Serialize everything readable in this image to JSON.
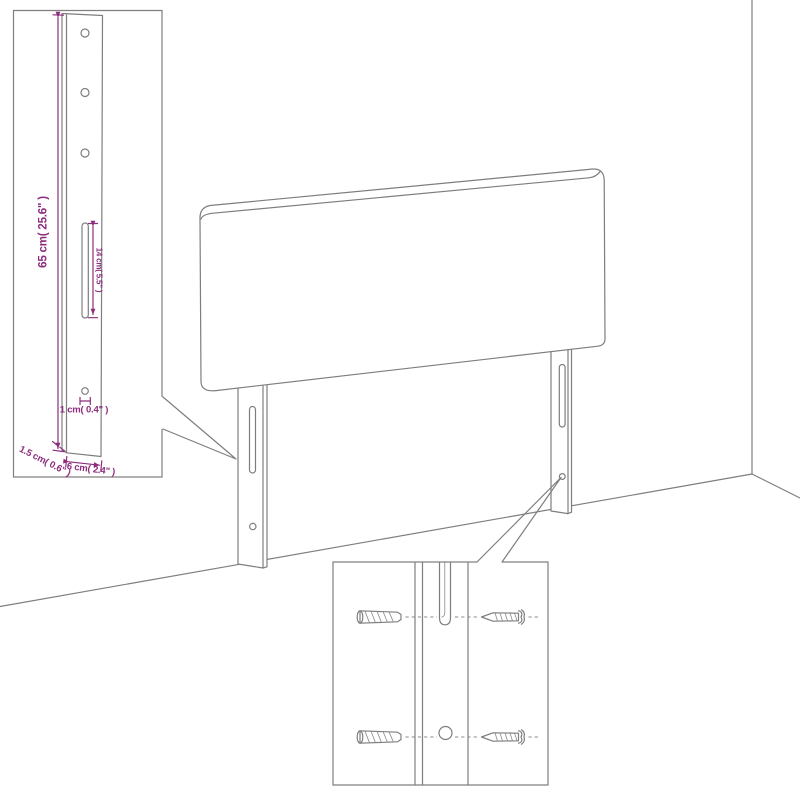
{
  "figure": {
    "description": "headboard with legs standing against wall corner, with enlarged leg-dimension inset and wall-mounting hardware inset",
    "colors": {
      "line_gray": "#7e7e7e",
      "dimension_magenta": "#8c2d7d",
      "background": "#ffffff"
    },
    "leg_detail_inset": {
      "height_label": "65 cm( 25.6\" )",
      "slot_label": "14 cm( 5.5\" )",
      "hole_label": "1 cm( 0.4\" )",
      "thickness_label": "1.5 cm( 0.6\" )",
      "width_label": "6 cm( 2.4\" )"
    },
    "mounting_detail_inset": {
      "hardware": [
        "wall-plug",
        "screw"
      ]
    }
  }
}
